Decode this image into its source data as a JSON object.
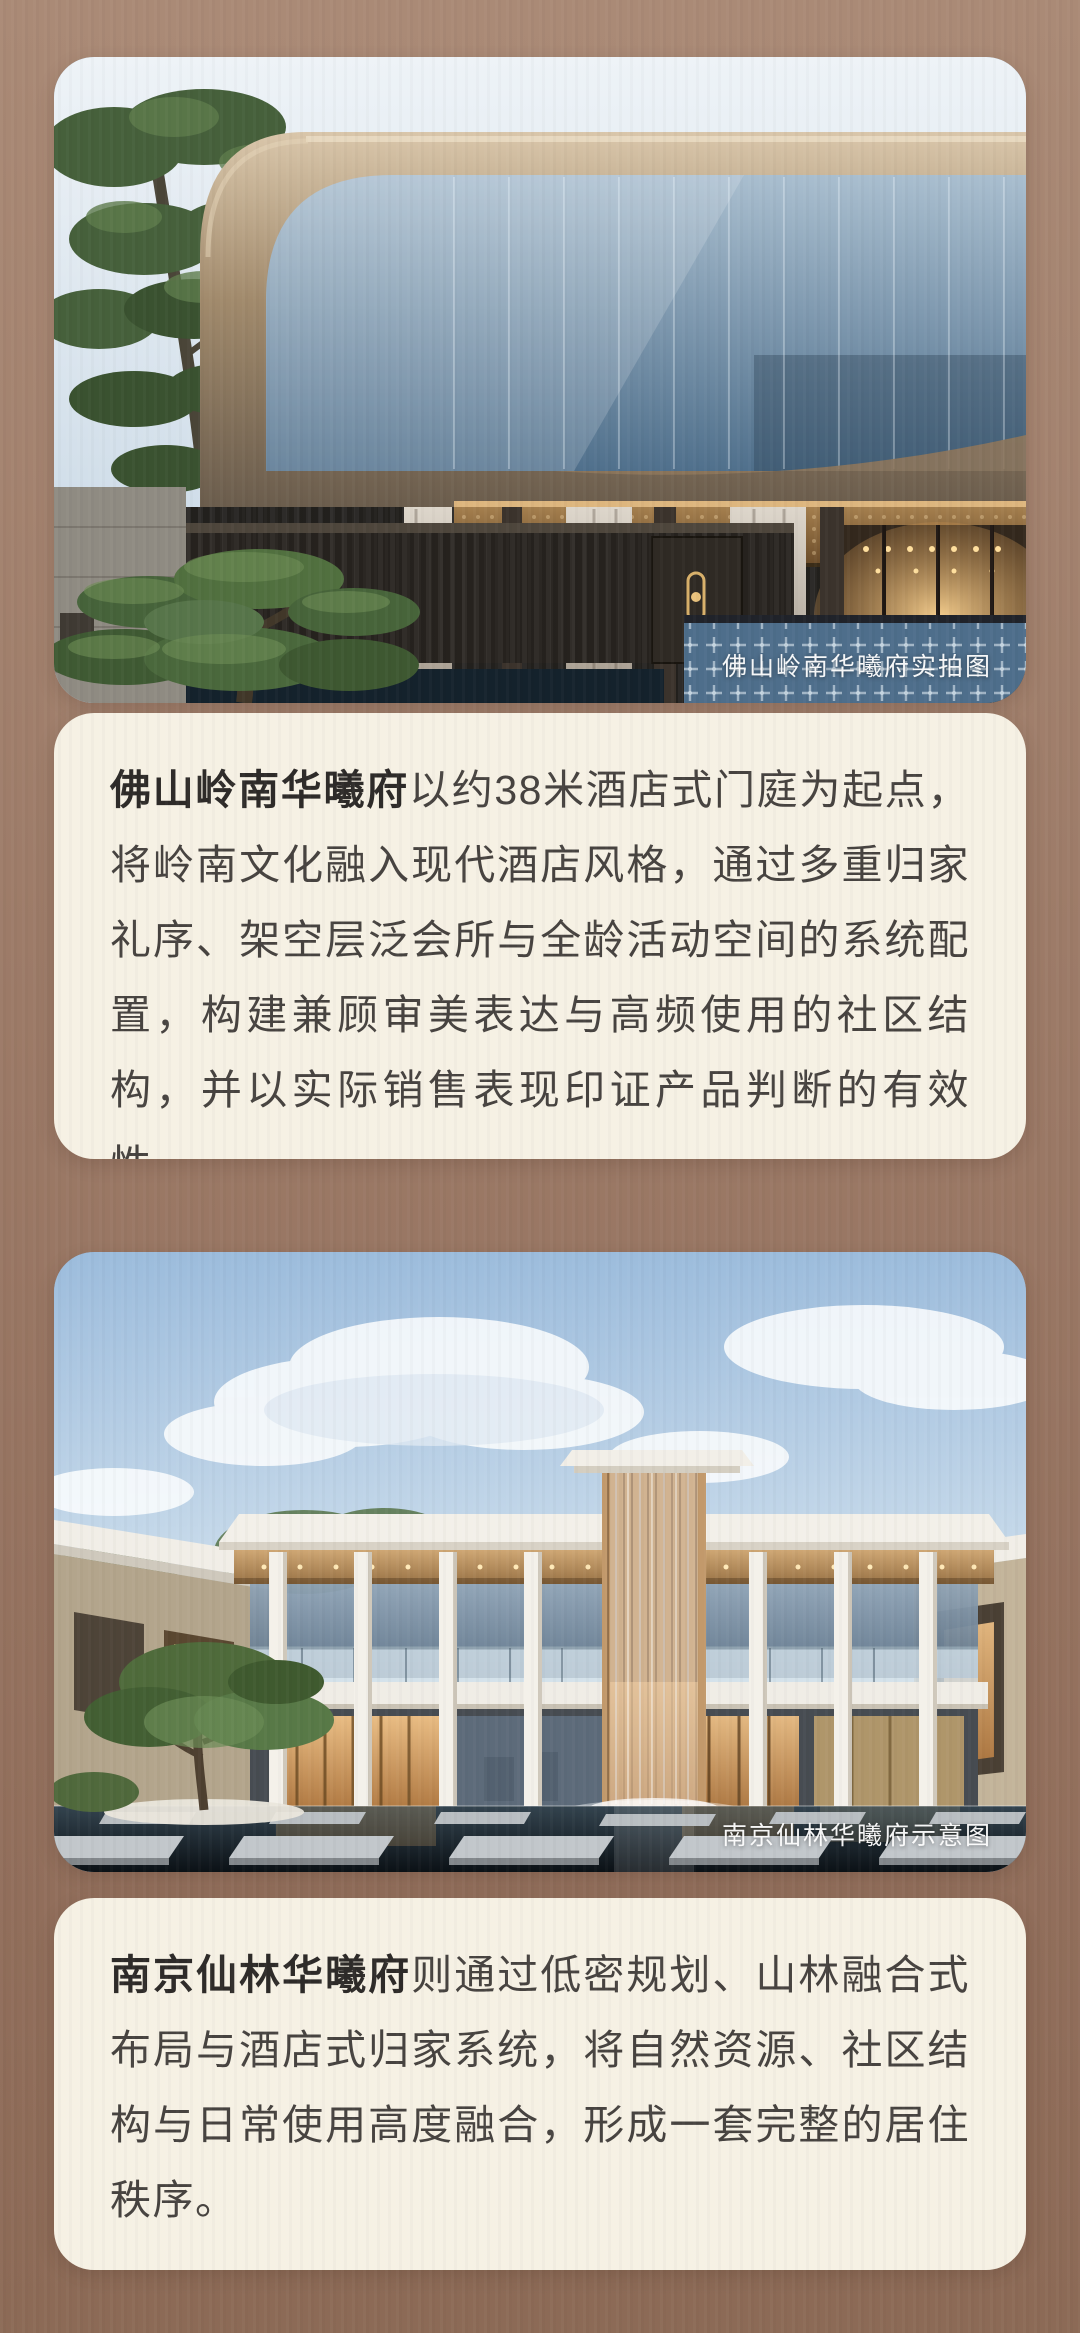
{
  "page": {
    "background_top": "#aa8a76",
    "background_bottom": "#8c6a56",
    "card_background": "#f6f1e4",
    "body_text_color": "#474340",
    "caption_text_color": "#ffffff"
  },
  "photo_foshan": {
    "caption": "佛山岭南华曦府实拍图"
  },
  "article_foshan": {
    "lead": "佛山岭南华曦府",
    "body": "以约38米酒店式门庭为起点，将岭南文化融入现代酒店风格，通过多重归家礼序、架空层泛会所与全龄活动空间的系统配置，构建兼顾审美表达与高频使用的社区结构，并以实际销售表现印证产品判断的有效性。"
  },
  "photo_nanjing": {
    "caption": "南京仙林华曦府示意图"
  },
  "article_nanjing": {
    "lead": "南京仙林华曦府",
    "body": "则通过低密规划、山林融合式布局与酒店式归家系统，将自然资源、社区结构与日常使用高度融合，形成一套完整的居住秩序。"
  }
}
